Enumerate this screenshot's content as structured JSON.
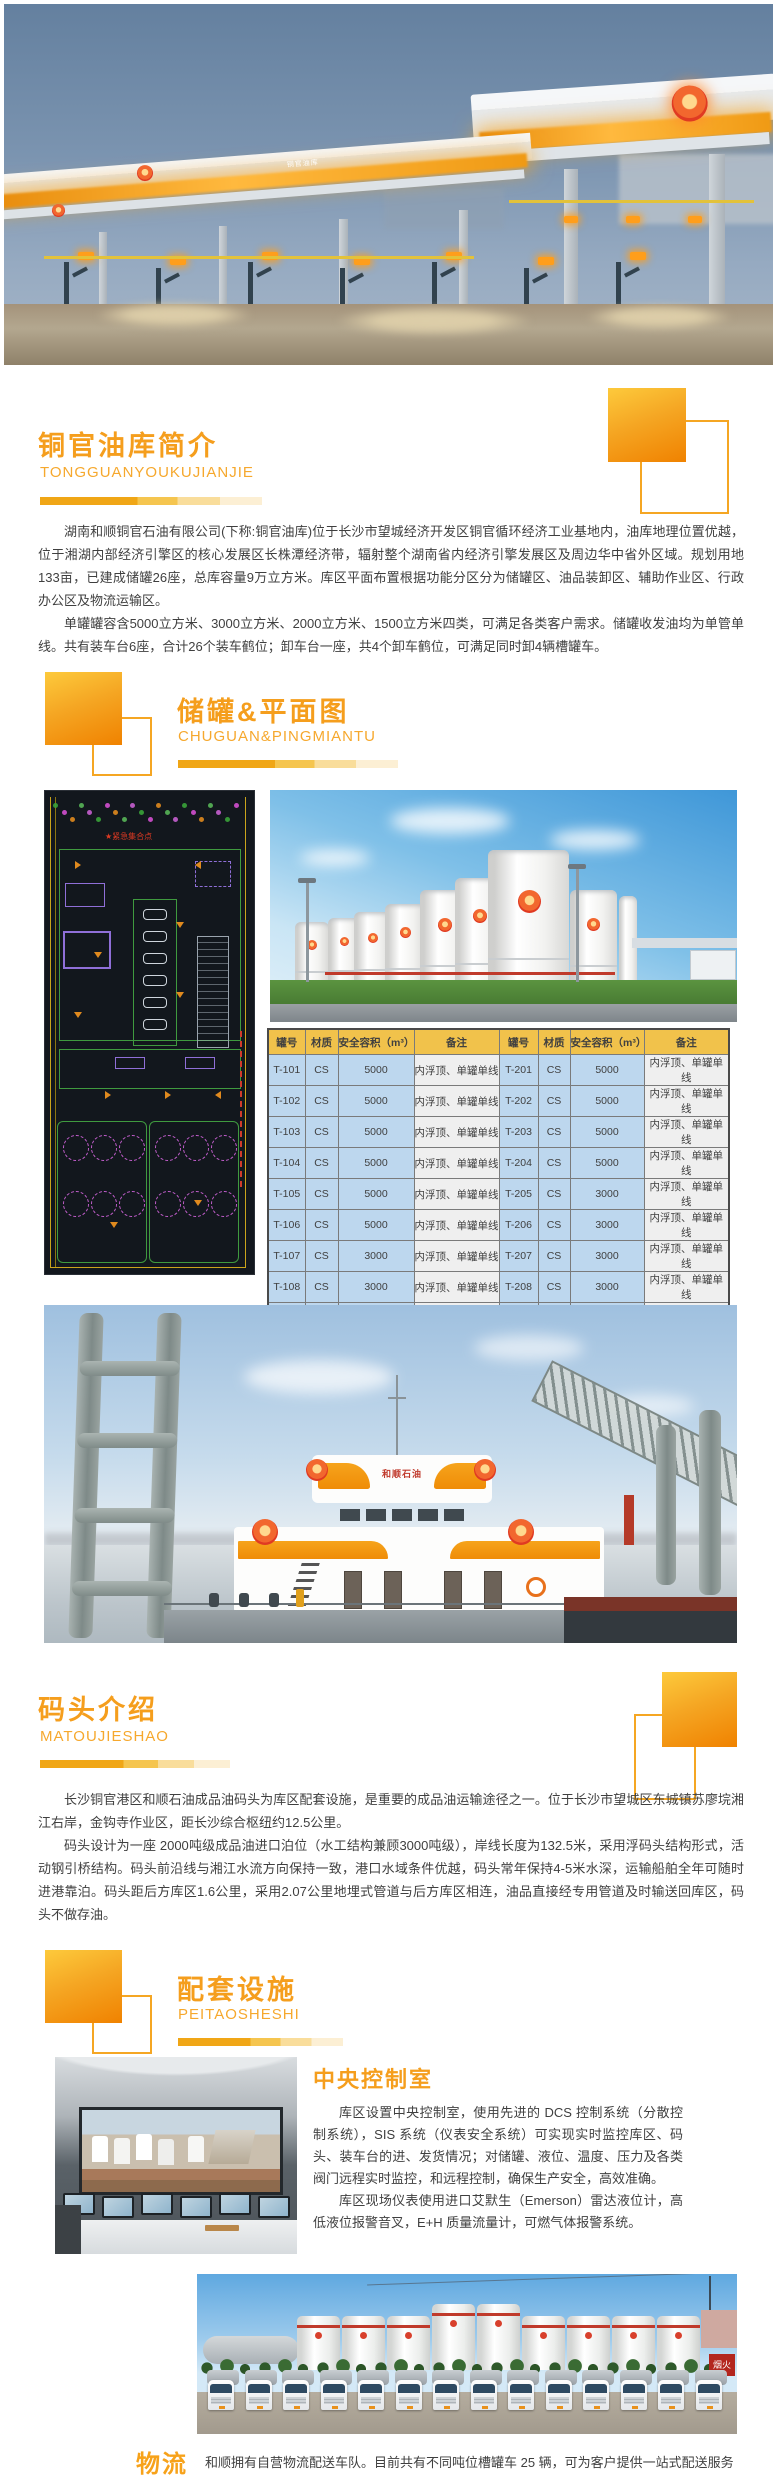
{
  "colors": {
    "accent": "#F59E1D",
    "accent_deep": "#F08200",
    "table_header_bg": "#F1C24B",
    "table_cell_blue": "#BDD7EE",
    "table_cell_gray": "#EFEFEF"
  },
  "hero": {
    "canopy_sign": "铜官油库"
  },
  "sections": {
    "intro": {
      "title": "铜官油库简介",
      "subtitle": "TONGGUANYOUKUJIANJIE",
      "paragraphs": [
        "湖南和顺铜官石油有限公司(下称:铜官油库)位于长沙市望城经济开发区铜官循环经济工业基地内，油库地理位置优越，位于湘湖内部经济引擎区的核心发展区长株潭经济带，辐射整个湖南省内经济引擎发展区及周边华中省外区域。规划用地133亩，已建成储罐26座，总库容量9万立方米。库区平面布置根据功能分区分为储罐区、油品装卸区、辅助作业区、行政办公区及物流运输区。",
        "单罐罐容含5000立方米、3000立方米、2000立方米、1500立方米四类，可满足各类客户需求。储罐收发油均为单管单线。共有装车台6座，合计26个装车鹤位；卸车台一座，共4个卸车鹤位，可满足同时卸4辆槽罐车。"
      ]
    },
    "tanks": {
      "title": "储罐&平面图",
      "subtitle": "CHUGUAN&PINGMIANTU",
      "plan_label": "紧急集合点",
      "table": {
        "headers": [
          "罐号",
          "材质",
          "安全容积（m³）",
          "备注",
          "罐号",
          "材质",
          "安全容积（m³）",
          "备注"
        ],
        "rows": [
          [
            "T-101",
            "CS",
            "5000",
            "内浮顶、单罐单线",
            "T-201",
            "CS",
            "5000",
            "内浮顶、单罐单线"
          ],
          [
            "T-102",
            "CS",
            "5000",
            "内浮顶、单罐单线",
            "T-202",
            "CS",
            "5000",
            "内浮顶、单罐单线"
          ],
          [
            "T-103",
            "CS",
            "5000",
            "内浮顶、单罐单线",
            "T-203",
            "CS",
            "5000",
            "内浮顶、单罐单线"
          ],
          [
            "T-104",
            "CS",
            "5000",
            "内浮顶、单罐单线",
            "T-204",
            "CS",
            "5000",
            "内浮顶、单罐单线"
          ],
          [
            "T-105",
            "CS",
            "5000",
            "内浮顶、单罐单线",
            "T-205",
            "CS",
            "3000",
            "内浮顶、单罐单线"
          ],
          [
            "T-106",
            "CS",
            "5000",
            "内浮顶、单罐单线",
            "T-206",
            "CS",
            "3000",
            "内浮顶、单罐单线"
          ],
          [
            "T-107",
            "CS",
            "3000",
            "内浮顶、单罐单线",
            "T-207",
            "CS",
            "3000",
            "内浮顶、单罐单线"
          ],
          [
            "T-108",
            "CS",
            "3000",
            "内浮顶、单罐单线",
            "T-208",
            "CS",
            "3000",
            "内浮顶、单罐单线"
          ],
          [
            "T-109",
            "CS",
            "3000",
            "内浮顶、单罐单线",
            "T-209",
            "CS",
            "3000",
            "内浮顶、单罐单线"
          ],
          [
            "T-110",
            "CS",
            "3000",
            "内浮顶、单罐单线",
            "T-210",
            "CS",
            "3000",
            "内浮顶、单罐单线"
          ],
          [
            "T-111",
            "CS",
            "1500",
            "内浮顶、单罐单线",
            "T-211",
            "CS",
            "2000",
            "内浮顶、单罐单线"
          ],
          [
            "T-112",
            "CS",
            "1500",
            "内浮顶、单罐单线",
            "T-212",
            "CS",
            "2000",
            "内浮顶、单罐单线"
          ],
          [
            "T-214",
            "CS",
            "1500",
            "内浮顶、单罐单线",
            "T-213",
            "CS",
            "1500",
            "内浮顶、单罐单线"
          ]
        ]
      }
    },
    "dock": {
      "title": "码头介绍",
      "subtitle": "MATOUJIESHAO",
      "ship_sign": "和顺石油",
      "paragraphs": [
        "长沙铜官港区和顺石油成品油码头为库区配套设施，是重要的成品油运输途径之一。位于长沙市望城区东城镇苏廖垸湘江右岸，金钩寺作业区，距长沙综合枢纽约12.5公里。",
        "码头设计为一座 2000吨级成品油进口泊位（水工结构兼顾3000吨级），岸线长度为132.5米，采用浮码头结构形式，活动钢引桥结构。码头前沿线与湘江水流方向保持一致，港口水域条件优越，码头常年保持4-5米水深，运输船舶全年可随时进港靠泊。码头距后方库区1.6公里，采用2.07公里地埋式管道与后方库区相连，油品直接经专用管道及时输送回库区，码头不做存油。"
      ]
    },
    "facilities": {
      "title": "配套设施",
      "subtitle": "PEITAOSHESHI",
      "control_room": {
        "title": "中央控制室",
        "paragraphs": [
          "库区设置中央控制室，使用先进的 DCS 控制系统（分散控制系统），SIS 系统（仪表安全系统）可实现实时监控库区、码头、装车台的进、发货情况；对储罐、液位、温度、压力及各类阀门远程实时监控，和远程控制，确保生产安全，高效准确。",
          "库区现场仪表使用进口艾默生（Emerson）雷达液位计，高低液位报警音叉，E+H 质量流量计，可燃气体报警系统。"
        ]
      },
      "fleet_sign": "烟火"
    },
    "logistics": {
      "title": "物流",
      "text": "和顺拥有自营物流配送车队。目前共有不同吨位槽罐车 25 辆，可为客户提供一站式配送服务"
    }
  }
}
